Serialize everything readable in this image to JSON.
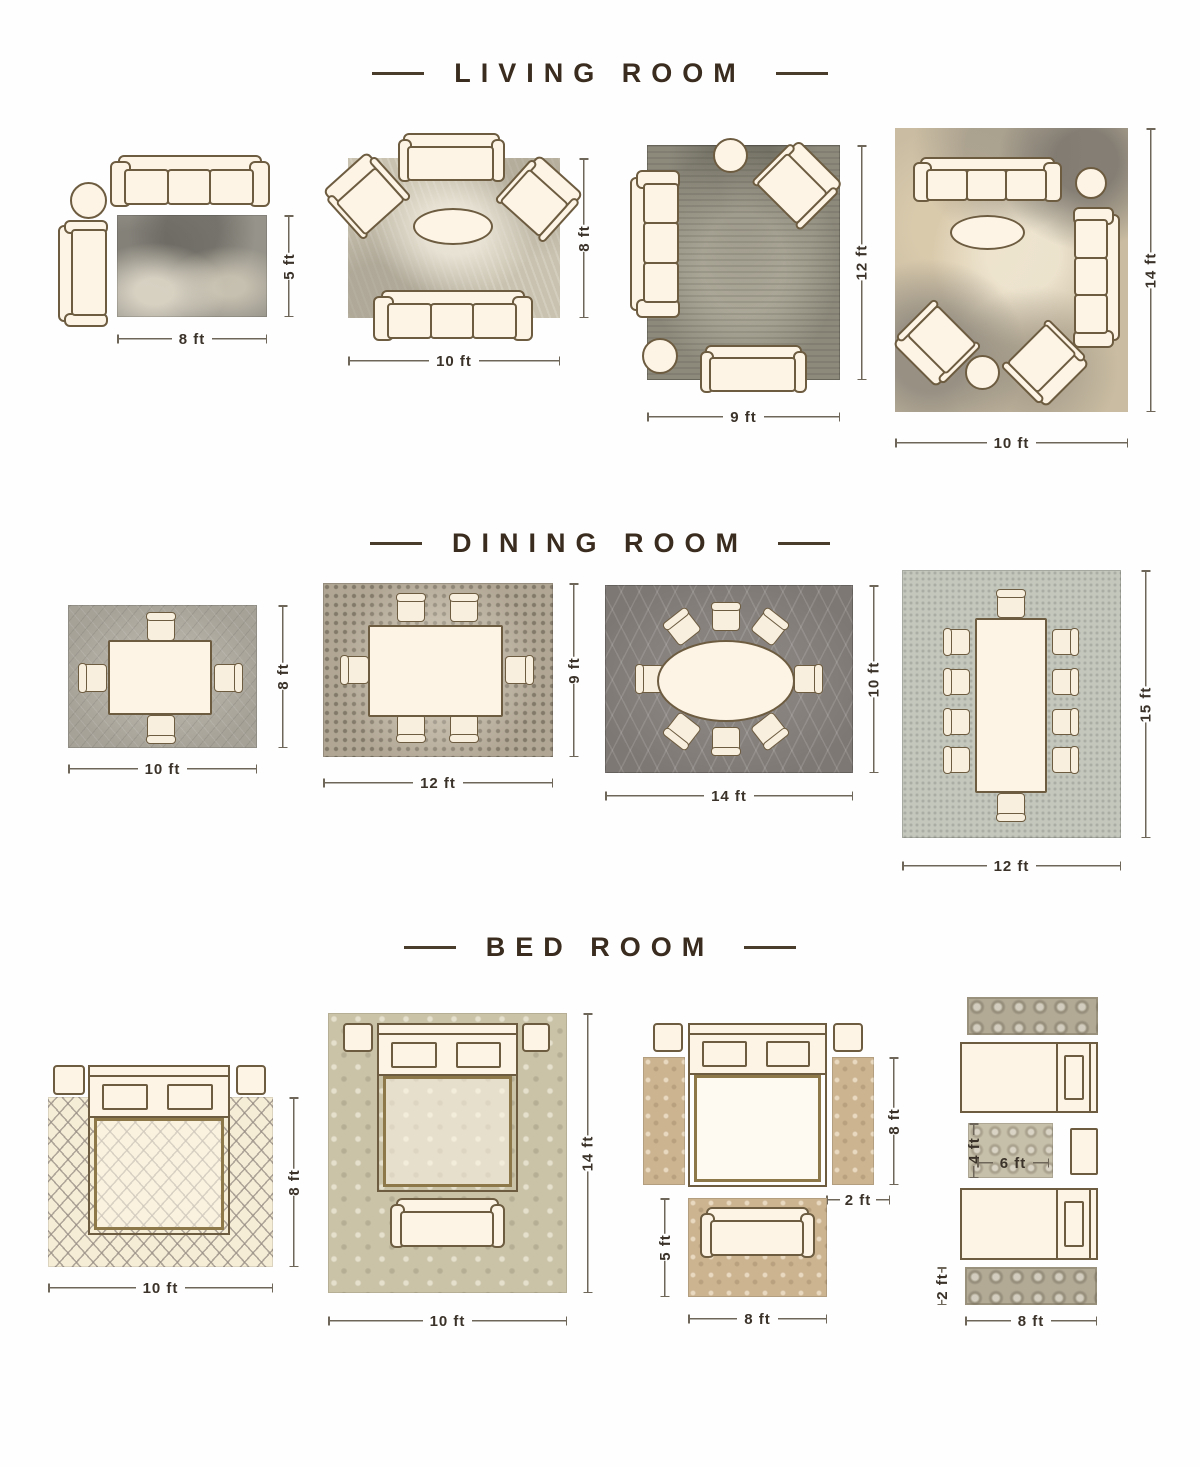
{
  "sections": [
    {
      "title": "LIVING ROOM",
      "layouts": [
        {
          "w": "8 ft",
          "h": "5 ft"
        },
        {
          "w": "10 ft",
          "h": "8 ft"
        },
        {
          "w": "9 ft",
          "h": "12 ft"
        },
        {
          "w": "10 ft",
          "h": "14 ft"
        }
      ]
    },
    {
      "title": "DINING ROOM",
      "layouts": [
        {
          "w": "10 ft",
          "h": "8 ft"
        },
        {
          "w": "12 ft",
          "h": "9 ft"
        },
        {
          "w": "14 ft",
          "h": "10 ft"
        },
        {
          "w": "12 ft",
          "h": "15 ft"
        }
      ]
    },
    {
      "title": "BED ROOM",
      "layouts": [
        {
          "w": "10 ft",
          "h": "8 ft"
        },
        {
          "w": "10 ft",
          "h": "14 ft"
        },
        {
          "bed_h": "8 ft",
          "runner_w": "2 ft",
          "foot_h": "5 ft",
          "foot_w": "8 ft"
        },
        {
          "mid_h": "4 ft",
          "mid_w": "6 ft",
          "runner_h": "2 ft",
          "runner_w": "8 ft"
        }
      ]
    }
  ],
  "colors": {
    "background": "#fefefe",
    "title_text": "#3a2d1f",
    "dimension_text": "#3b332a",
    "dimension_line": "#6f665a",
    "furniture_fill": "#fdf4e6",
    "furniture_outline": "#6d5c40",
    "blanket_outline": "#8c7848"
  }
}
